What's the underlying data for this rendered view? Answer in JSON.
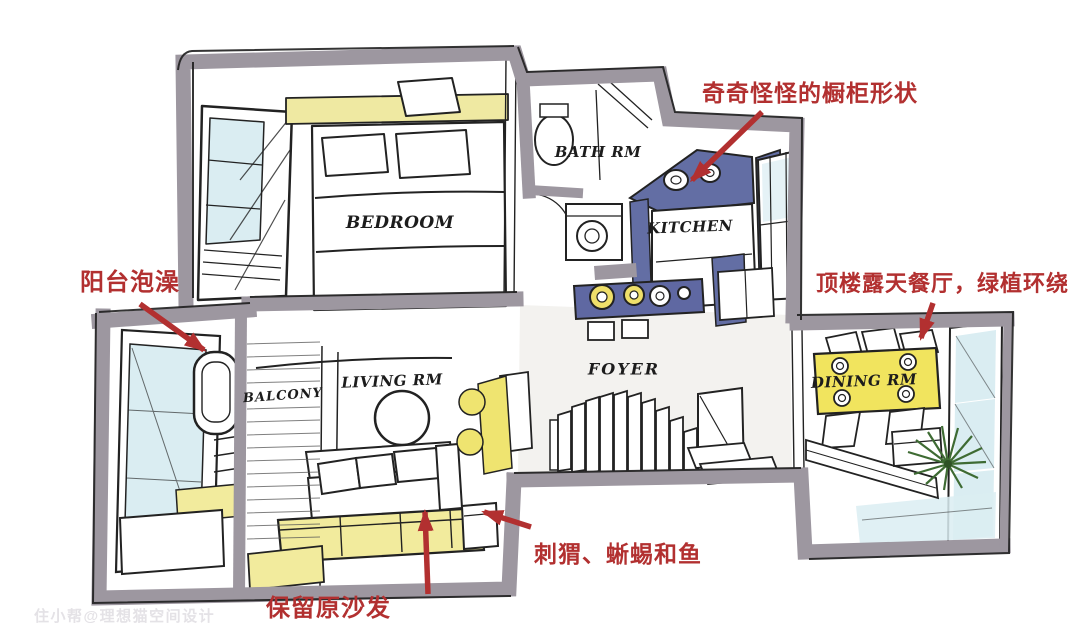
{
  "rooms": {
    "bedroom": {
      "label": "BEDROOM"
    },
    "bath": {
      "label": "BATH RM"
    },
    "kitchen": {
      "label": "KITCHEN"
    },
    "foyer": {
      "label": "FOYER"
    },
    "living": {
      "label": "LIVING RM"
    },
    "balcony": {
      "label": "BALCONY"
    },
    "dining": {
      "label": "DINING RM"
    }
  },
  "annotations": {
    "cabinet": {
      "text": "奇奇怪怪的橱柜形状"
    },
    "balcony_bath": {
      "text": "阳台泡澡"
    },
    "rooftop_dining": {
      "text": "顶楼露天餐厅，绿植环绕"
    },
    "pets": {
      "text": "刺猬、蜥蜴和鱼"
    },
    "sofa": {
      "text": "保留原沙发"
    }
  },
  "watermark": {
    "text": "住小帮@理想猫空间设计"
  },
  "palette": {
    "wall_gray": "#9d97a0",
    "cabinet_blue": "#636ea4",
    "bar_blue": "#5f68a2",
    "accent_yellow": "#f2eb9d",
    "table_yellow": "#f1e45e",
    "glass_blue": "#daedf2",
    "annotation_red": "#b23030",
    "plant_green": "#3e6b33",
    "ink": "#1f1f1f"
  }
}
